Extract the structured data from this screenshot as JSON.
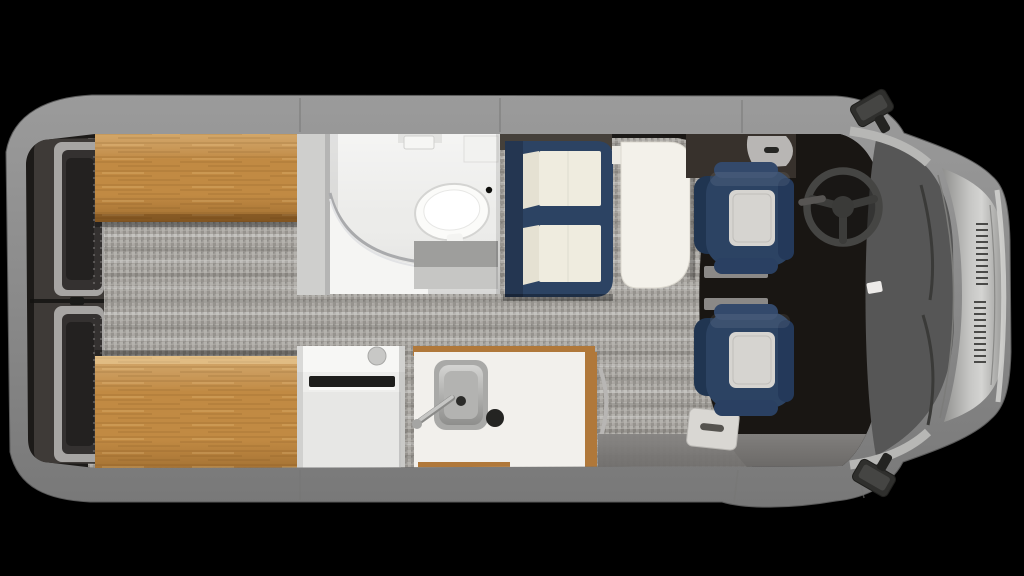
{
  "scene": {
    "name": "camper-van-floor-plan-top-view",
    "view": "overhead",
    "background": "black"
  },
  "legend": [
    "rear-doors",
    "rear-bench-top",
    "rear-bench-bottom",
    "aisle-carpet",
    "wet-bath",
    "toilet",
    "shower-door",
    "bath-partition",
    "sofa",
    "sofa-cushions",
    "dinette-table",
    "refrigerator-cabinet",
    "galley-counter",
    "kitchen-sink",
    "stove-knob",
    "entry-step",
    "cab-floor",
    "driver-seat",
    "passenger-seat",
    "steering-wheel",
    "windshield",
    "hood",
    "cowl-vents",
    "side-mirrors",
    "rearview-mirror"
  ],
  "colors": {
    "canvas": "#000000",
    "interior": "#1c1a18",
    "cabFloor": "#191613",
    "carpet": "#a8a5a0",
    "wood": "#c18a43",
    "woodStrip": "#b0783a",
    "doorFrame": "#a7a5a3",
    "doorPanel": "#343130",
    "bath": "#ececea",
    "toilet": "#fbfbf9",
    "stepGray": "#9e9e9c",
    "navy": "#2c4363",
    "navyDark": "#203551",
    "cream": "#efecdf",
    "table": "#f3f1ea",
    "trim": "#b8b6b4",
    "cabinet": "#eeeeec",
    "counter": "#f2f0ec",
    "sinkSteel": "#a9a9a7",
    "knob": "#242422",
    "headrest": "#d6d4d0",
    "pedestal": "#8b8987",
    "windshield": "#565656",
    "wheel": "#454543",
    "mirror": "#2f2f2d",
    "stepWhite": "#d9d7d3"
  }
}
